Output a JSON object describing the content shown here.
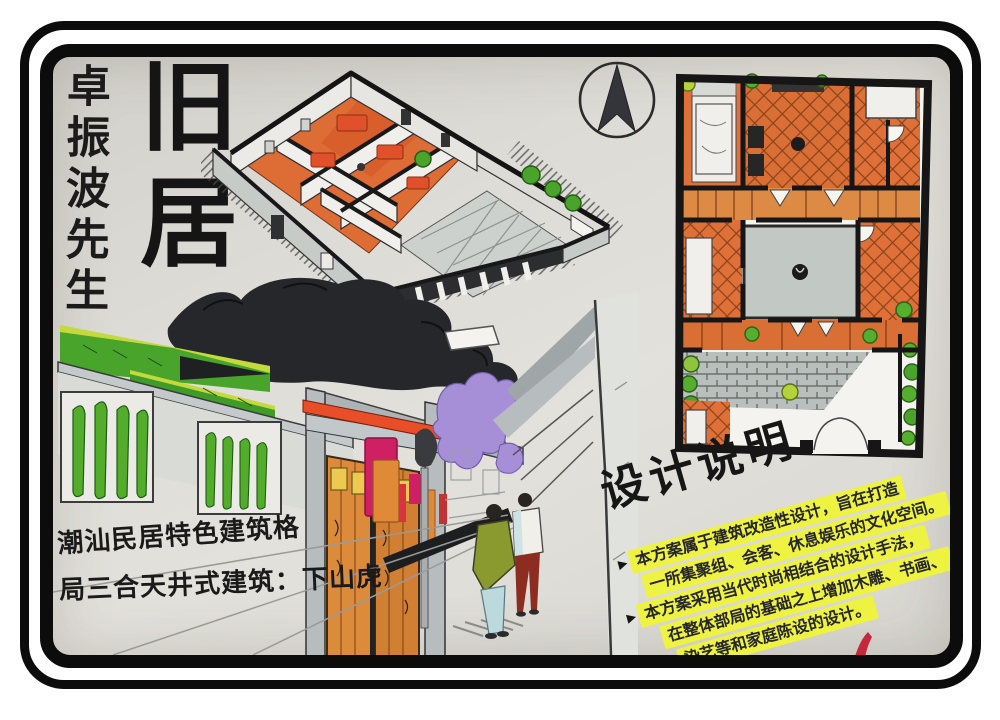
{
  "titles": {
    "owner_vertical": "卓振波先生",
    "main": "旧居"
  },
  "captions": {
    "line1": "潮汕民居特色建筑格",
    "line2": "局三合天井式建筑：下山虎"
  },
  "design_notes": {
    "title": "设计说明",
    "lines": [
      {
        "marker": "▶",
        "text": "本方案属于建筑改造性设计，旨在打造"
      },
      {
        "marker": "",
        "text": "一所集聚组、会客、休息娱乐的文化空间。"
      },
      {
        "marker": "▶",
        "text": "本方案采用当代时尚相结合的设计手法，"
      },
      {
        "marker": "",
        "text": "在整体部局的基础之上增加木雕、书画、"
      },
      {
        "marker": "",
        "text": "染艺等和家庭陈设的设计。"
      }
    ]
  },
  "icons": {
    "north_arrow": "north-arrow-compass",
    "red_mark": "red-signature-mark"
  },
  "colors": {
    "frame_black": "#0c0c0c",
    "paper": "#dedcd6",
    "ink_black": "#1b1b1b",
    "room_orange": "#df7038",
    "accent_red_orange": "#e8502a",
    "courtyard_gray": "#c2c9c4",
    "wall_gray": "#b7bdbf",
    "foliage_green": "#4fa82c",
    "foliage_yellow_green": "#c4d93e",
    "lantern_magenta": "#ce2063",
    "purple": "#a78fd8",
    "highlight_yellow": "#eef241",
    "jacket_olive": "#8a9a2e",
    "pants_red": "#8d2c20",
    "red_mark": "#c5283c"
  }
}
